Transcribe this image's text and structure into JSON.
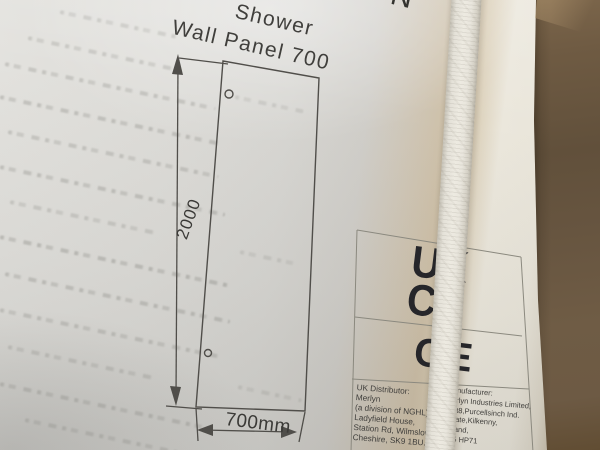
{
  "label": {
    "brand_fragment": "N",
    "title_line1": "Shower",
    "title_line2": "Wall Panel 700",
    "diagram": {
      "height_dim": "2000",
      "width_dim": "700mm"
    },
    "marks": {
      "ukca_top": "UK",
      "ukca_bottom": "CA",
      "ce": "CE"
    },
    "distributor_lines": [
      "UK Distributor:",
      "Merlyn",
      "(a division of NGHL),",
      "Ladyfield House,",
      "Station Rd, Wilmslow,",
      "Cheshire, SK9 1BU."
    ],
    "manufacturer_lines": [
      "Manufacturer:",
      "Merlyn Industries Limited,",
      "Unit8,Purcellsinch Ind.",
      "Estate,Kilkenny,",
      "Ireland,",
      "R95 HP71"
    ]
  },
  "colors": {
    "paper": "#deddd9",
    "cardboard": "#6d5a44",
    "strap": "#e9e6dd",
    "ink": "#3a3a38"
  }
}
